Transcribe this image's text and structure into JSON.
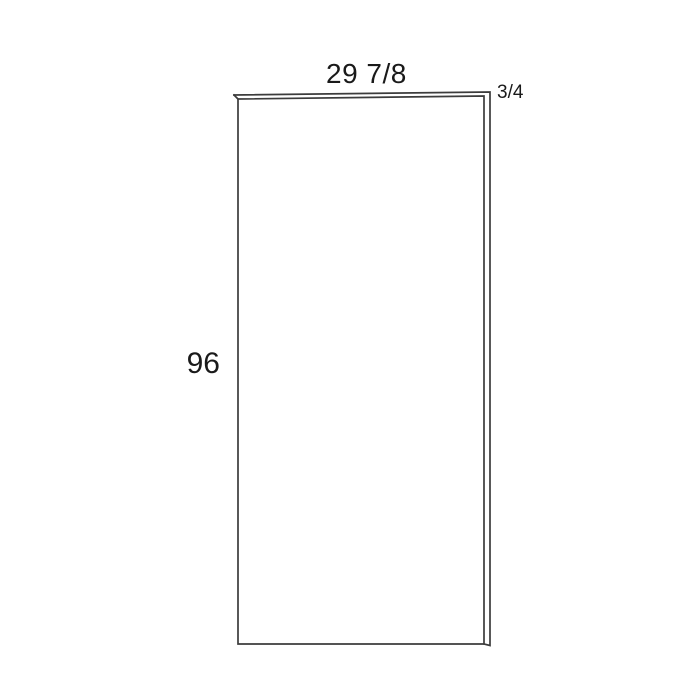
{
  "drawing": {
    "description": "panel dimension diagram",
    "dimensions": {
      "width": "29 7/8",
      "height": "96",
      "thickness": "3/4"
    },
    "colors": {
      "line": "#3c3c3c",
      "face_fill": "#ffffff",
      "text": "#1a1a1a",
      "background": "#ffffff"
    }
  }
}
